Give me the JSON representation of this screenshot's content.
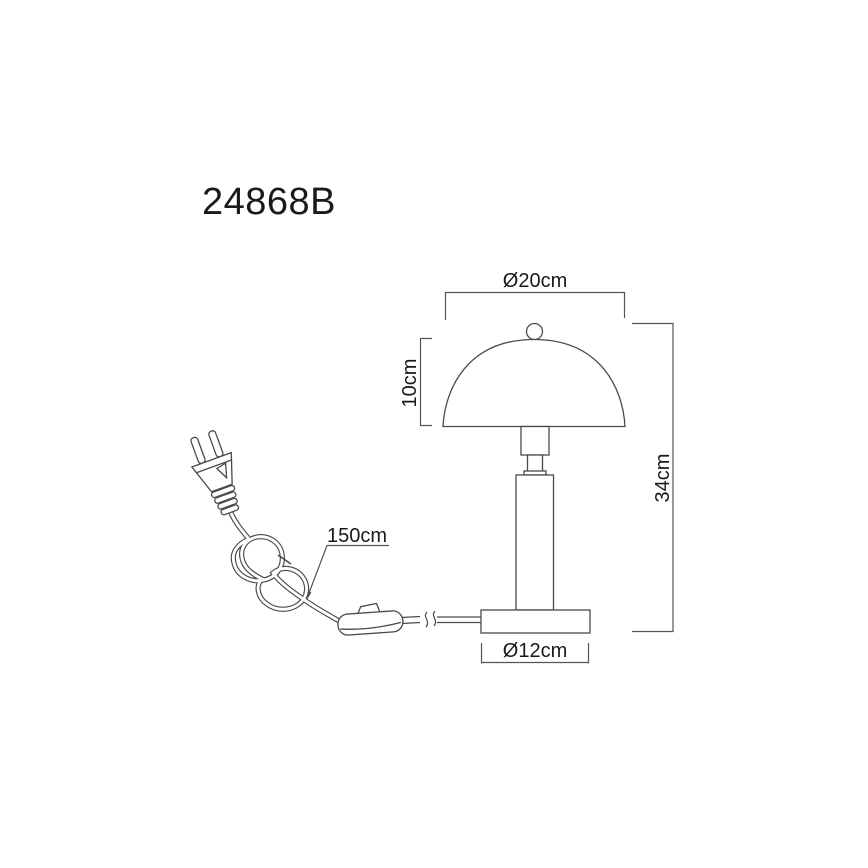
{
  "product": {
    "code": "24868B"
  },
  "dimensions": {
    "shade_diameter": "Ø20cm",
    "shade_height": "10cm",
    "total_height": "34cm",
    "base_diameter": "Ø12cm",
    "cable_length": "150cm"
  },
  "colors": {
    "background": "#ffffff",
    "line": "#4a4a4a",
    "dimension_line": "#555555",
    "text": "#1a1a1a"
  }
}
